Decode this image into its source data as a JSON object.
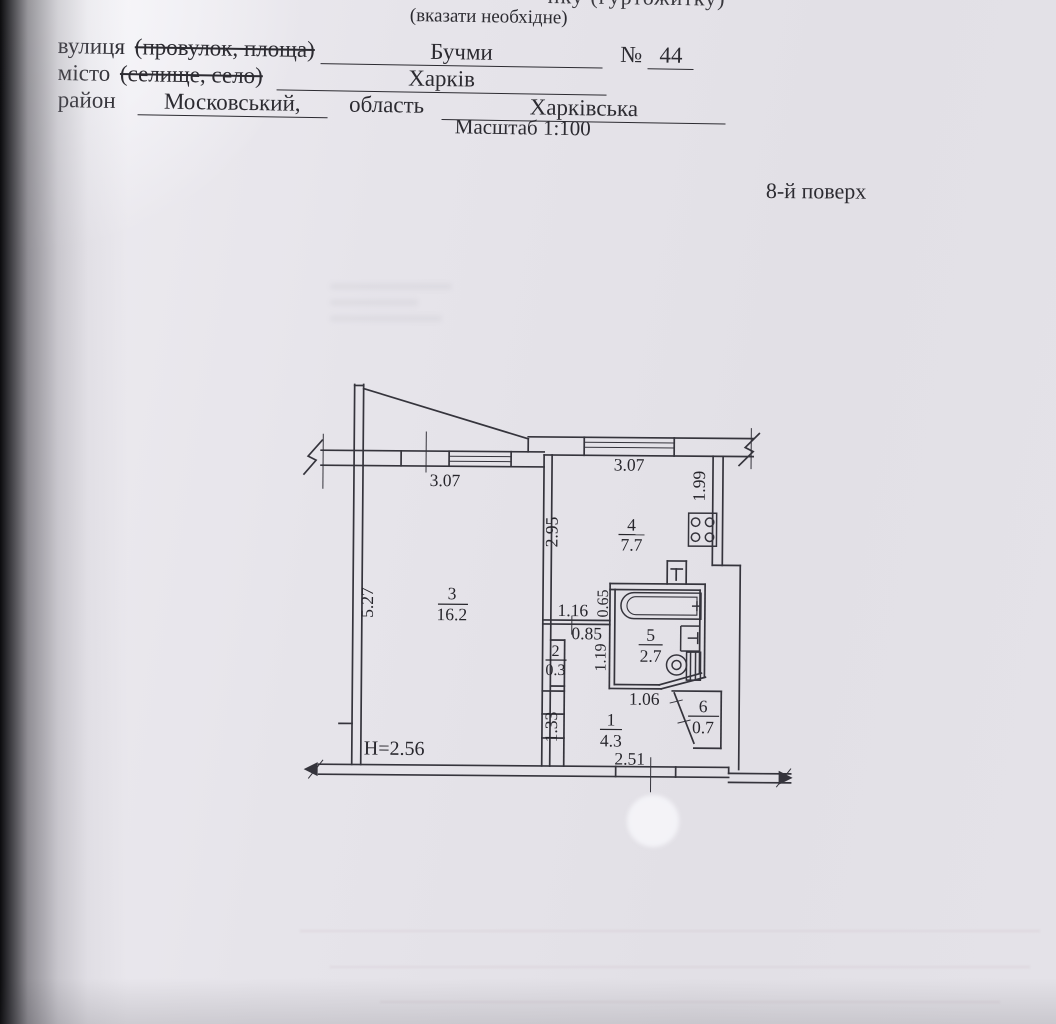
{
  "header": {
    "clipped_line": "нку (гуртожитку)",
    "note": "(вказати необхідне)",
    "street": {
      "label": "вулиця",
      "struck": "(провулок, площа)",
      "value": "Бучми",
      "no_label": "№",
      "no_value": "44"
    },
    "city": {
      "label": "місто",
      "struck": "(селище, село)",
      "value": "Харків"
    },
    "district": {
      "label": "район",
      "value": "Московський,",
      "region_label": "область",
      "region_value": "Харківська"
    },
    "scale": "Масштаб 1:100",
    "floor": "8-й поверх"
  },
  "plan": {
    "height_mark": "Н=2.56",
    "rooms": {
      "r1": {
        "num": "1",
        "area": "4.3"
      },
      "r2": {
        "num": "2",
        "area": "0.3"
      },
      "r3": {
        "num": "3",
        "area": "16.2"
      },
      "r4": {
        "num": "4",
        "area": "7.7"
      },
      "r5": {
        "num": "5",
        "area": "2.7"
      },
      "r6": {
        "num": "6",
        "area": "0.7"
      }
    },
    "dims": {
      "win_left": "3.07",
      "win_right": "3.07",
      "d199": "1.99",
      "d295": "2.95",
      "d527": "5.27",
      "d116": "1.16",
      "d085": "0.85",
      "d065": "0.65",
      "d119": "1.19",
      "d106": "1.06",
      "d133": "1.33",
      "d251": "2.51"
    }
  },
  "colors": {
    "ink": "#2c2b31",
    "paper": "#e4e2e8"
  }
}
